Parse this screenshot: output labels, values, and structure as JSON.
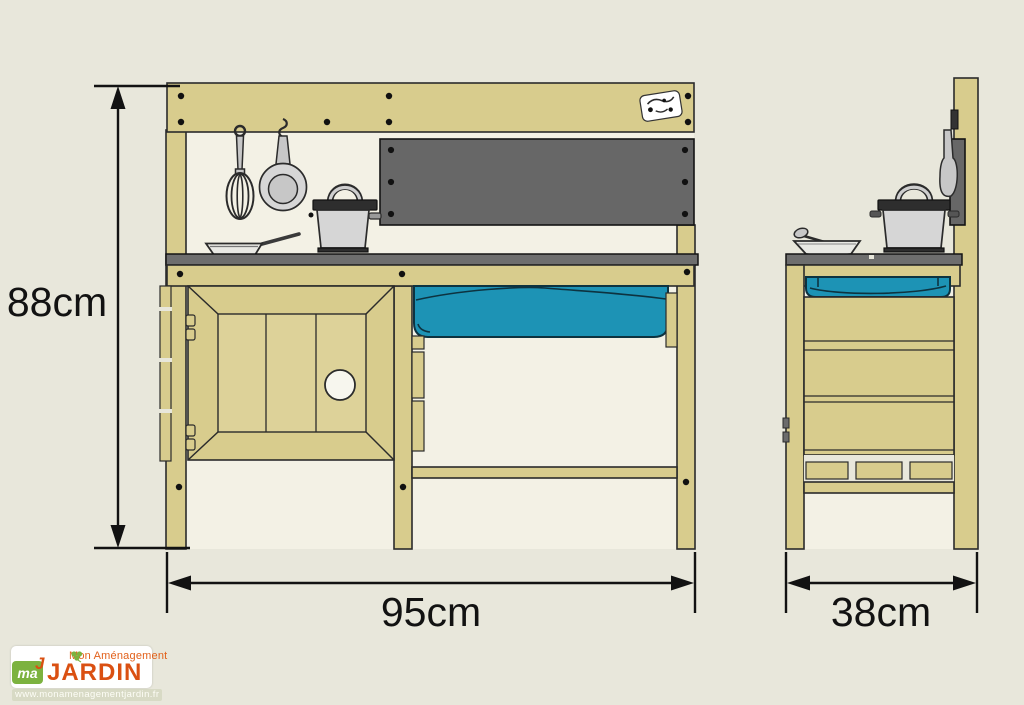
{
  "colors": {
    "page-bg": "#e8e7db",
    "panel-bg": "#f3f1e5",
    "wood": "#d8cc8d",
    "wood-light": "#ddd299",
    "outline": "#2b2b2b",
    "counter": "#6e6e6e",
    "backsplash": "#676767",
    "basin": "#1d93b5",
    "metal": "#d6d6d6",
    "dim": "#121212",
    "brand-orange": "#da5012",
    "brand-orange-light": "#e2611b",
    "brand-green": "#7cb23f"
  },
  "diagram": {
    "dimensions": {
      "height": "88cm",
      "width": "95cm",
      "depth": "38cm"
    }
  },
  "logo": {
    "brand_line1": "Mon Aménagement",
    "brand_line2": "JARDIN",
    "monogram": "ma",
    "monogram_j": "J",
    "website": "www.monamenagementjardin.fr"
  }
}
